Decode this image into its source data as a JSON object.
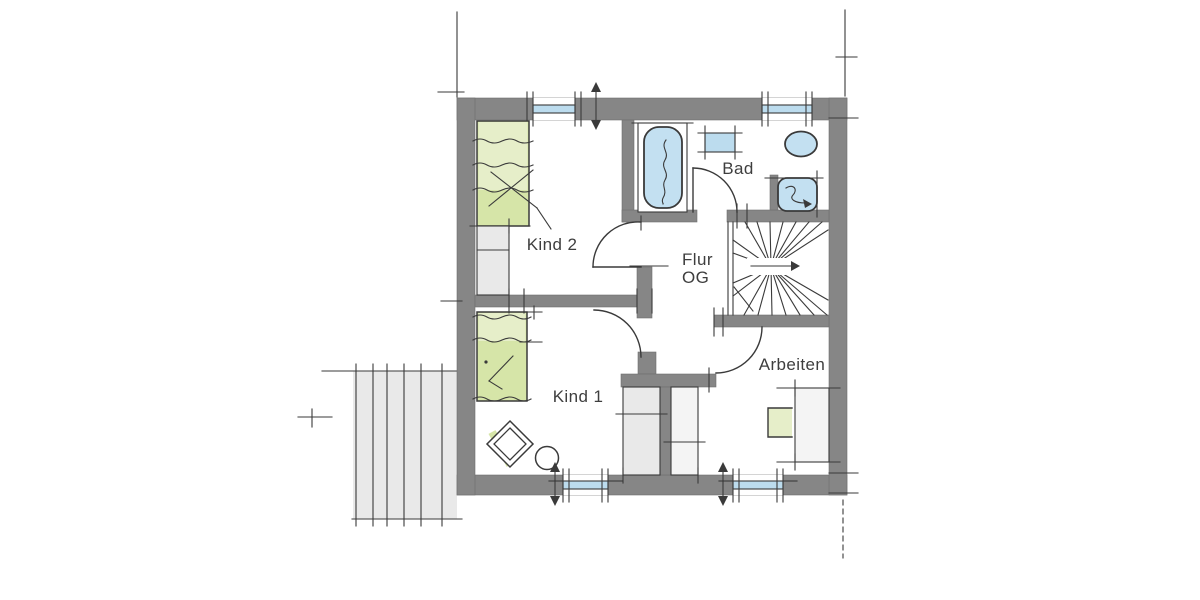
{
  "floorplan": {
    "rooms": {
      "kind2": {
        "label": "Kind 2"
      },
      "kind1": {
        "label": "Kind 1"
      },
      "bad": {
        "label": "Bad"
      },
      "arbeiten": {
        "label": "Arbeiten"
      },
      "flur": {
        "line1": "Flur",
        "line2": "OG"
      }
    },
    "colors": {
      "wall": "#868686",
      "wall-edge": "#6f6f6f",
      "line": "#3a3a3a",
      "glass": "#bcdcee",
      "fixture": "#c3e0f1",
      "green": "#d6e5a8",
      "green-light": "#e6eec9",
      "gray-light": "#e9e9e9",
      "gray-lighter": "#f4f4f4",
      "label": "#3e3e3e",
      "bg": "#ffffff"
    }
  }
}
